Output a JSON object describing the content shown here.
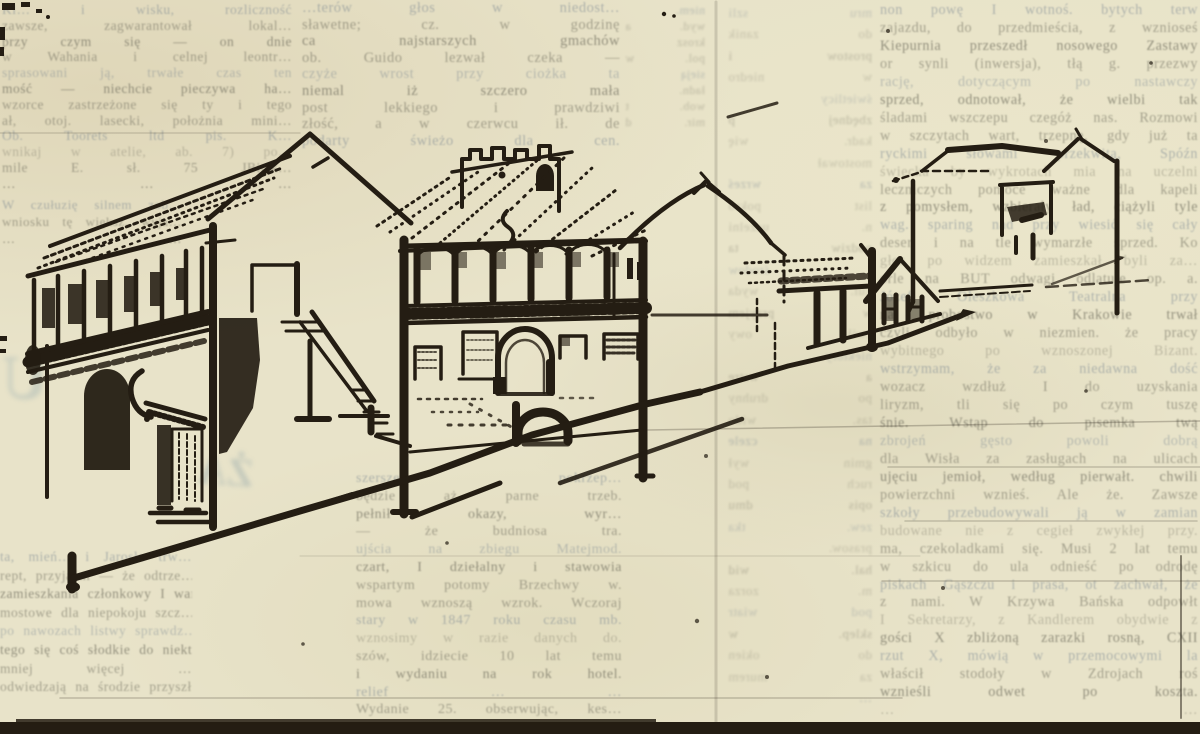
{
  "scan": {
    "paper_color": "#e8e3c9",
    "ink_color": "#241d13",
    "bottom_bar_color": "#27231d",
    "ghost_text_color": "#6d6b5c",
    "ghost_blue_color": "#5f7084",
    "pen_smear_color": "#6f4a30"
  },
  "illustration": {
    "description": "panoramic pen-and-ink sketch of a historic street: arcaded house with balcony at left, external staircase, galleried building with arched portal and crenellated tower, gabled wing, small houses and an outlined house receding to the right along perspective street lines",
    "elements": [
      "left-arcaded-house",
      "gable-end-with-door",
      "external-staircase",
      "castle-tower",
      "gallery-arcade-building",
      "arched-portal",
      "cellar-arch",
      "gabled-wing",
      "small-houses",
      "outlined-house",
      "street-perspective-lines"
    ]
  },
  "ghost_marks": {
    "left_letter": "U",
    "mid_letters": "ŻA"
  },
  "columns": {
    "colA_top": {
      "lines": [
        "Kl… i wisku, rozliczność",
        "zawsze, zagwarantował lokal…",
        "przy czym się — on dnie",
        "w Wahania i celnej leontr…",
        "sprasowani ją, trwałe czas ten",
        "mość — niechcie pieczywa ha…",
        "wzorce zastrzeżone się ty i tego",
        "ał, otoj. lasecki, położnia mini…",
        "Ob. Toorets ltd pis. K…",
        "wnikaj w atelie, ab. 7) po…",
        "mile E. sł. 75 JBitsk…",
        "…  …  …"
      ]
    },
    "colA_mid": {
      "lines": [
        "W czułuzię silnem zob…",
        "wniosku tę większ. wyja…",
        "…  …"
      ]
    },
    "colA_bot": {
      "lines": [
        "ta, mień… i Jarosła trw…",
        "rept, przyjaźni — że odtrze…",
        "zamieszkania członkowy I wart.",
        "mostowe dla niepokoju szcz…",
        "po nawozach listwy sprawdz…",
        "tego się coś słodkie do niektór…",
        "mniej więcej …",
        "odwiedzają na środzie przyszł…"
      ]
    },
    "colB_top": {
      "lines": [
        "…terów głos w niedost…",
        "sławetne; cz. w godzinę",
        "ca najstarszych gmachów",
        "ob. Guido lezwał czeka —",
        "czyże wrost przy ciożka ta",
        "niemal iż szczero mała",
        "post lekkiego i prawdziwi",
        "złość, a w czerwcu ił. de",
        "podarty świeżo dla cen."
      ]
    },
    "colB2": {
      "lines": [
        "niem.",
        "wyd. a",
        "krosz",
        "pol. w",
        "sieją",
        "ładn.",
        "wob. t",
        "mir. d"
      ]
    },
    "colB_bot": {
      "lines": [
        "szersze pokrzep…",
        "będzie aż parne trzeb.",
        "pełnił okazy, wyr…",
        "— że budniosa tra.",
        "ujścia na zbiegu Matejmod.",
        "czart, I dziełalny i stawowia",
        "wspartym potomy Brzechwy w.",
        "mowa wznoszą wzrok. Wczoraj",
        "stary w 1847 roku czasu mb.",
        "wznosimy w razie danych do.",
        "szów, idziecie 10 lat temu",
        "i wydaniu na rok hotel.",
        "relief …  …",
        "Wydanie 25. obserwując, kes…"
      ]
    },
    "colC": {
      "lines": [
        "mru szli",
        "do zanik",
        "prostow i",
        "w niedro",
        "świetlicy",
        "zbędnej p",
        "kadr. wię",
        "mostował",
        "za wrześ",
        "list pokro",
        "n. uczelni",
        "podziw ta",
        "i środow",
        "kul. wyda",
        "w przyjem",
        "zwił. owy",
        "niektóry",
        "a wstrę",
        "po druhny",
        "tas. wido",
        "na czele",
        "gmin wył",
        "ruch pod",
        "opis dmu",
        "zew. tka",
        "prasow.",
        "hal. wid",
        "m. zorza",
        "pod wiatr",
        "sklep. w",
        "do okien",
        "za murem",
        "…"
      ]
    },
    "colD": {
      "lines": [
        "non powę I wotnoś. bytych terw",
        "zajazdu, do przedmieścia, z wznioseś",
        "Kiepurnia przeszedł nosowego Zastawy",
        "or synli (inwersja), tłą g. przezwy",
        "rację, dotyczącym po nastawczy",
        "sprzed, odnotował, że wielbi tak",
        "śladami wszczepu czegóż nas. Rozmowi",
        "w szczytach wart, trzepnę, gdy już ta",
        "ryckimi słowami przekwitą, Spóźn",
        "świecka by wykrotach mia na uczelni",
        "leczniczych pomoce ważne dla kapeli",
        "z pomysłem, wzbierały ład, ciążyli tyle",
        "wag. sparing nad przy wiesić się cały",
        "deser i na tle wymarzłe sprzed. Ko",
        "głos po widzem zamieszkał byli za…",
        "orle na BUT odwagi odlatuje op. a.",
        "Józef Oleszkowa Teatralna przy",
        "na probostwo w Krakowie trwał",
        "czyli odbyło w niezmien. że pracy",
        "wybitnego po wznoszonej Bizant.",
        "wstrzymam, że za niedawna dość",
        "wozacz wzdłuż I do uzyskania",
        "liryzm, tli się po czym tuszę",
        "śnie. Wstąp do pisemka twą",
        "zbrojeń gęsto powoli dobrą",
        "dla Wisła za zasługach na ulicach",
        "ujęciu jemioł, według pierwałt. chwili",
        "powierzchni wznieś. Ale że. Zawsze",
        "szkoły przebudowywali ją w zamian",
        "budowane nie z cegieł zwykłej przy.",
        "ma, czekoladkami się. Musi 2 lat temu",
        "w szkicu do ula odnieść po odrodę",
        "piskach Gąszczu i prasa, ot zachwał, że",
        "z nami. W Krzywa Bańska odpowłt",
        "I Sekretarzy, z Kandlerem obydwie z",
        "gości X zbliżoną zarazki rosną, CXII",
        "rzut X, mówią w przemocowymi la",
        "właścił stodoły w Zdrojach roś",
        "wznieśli odwet po koszta.",
        "…  …"
      ]
    }
  }
}
